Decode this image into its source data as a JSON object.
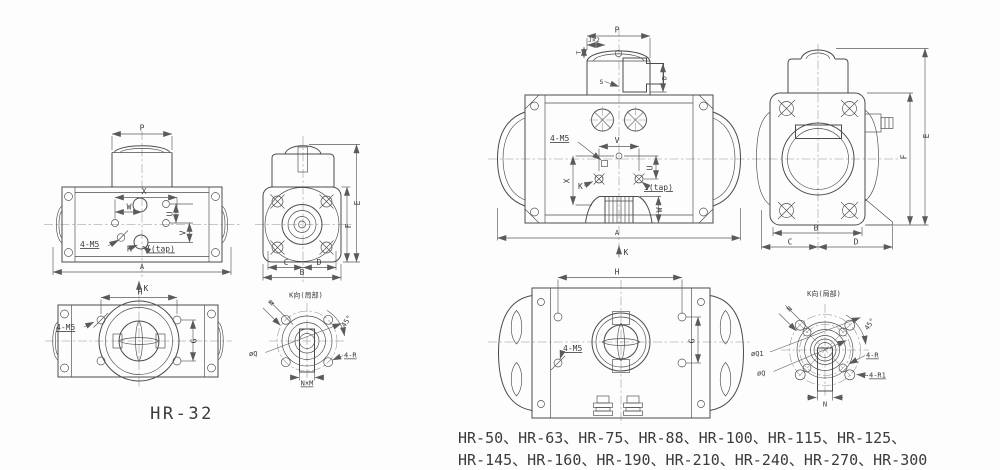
{
  "page": {
    "background": "#fdfdfd",
    "line_color": "#4b4b4b"
  },
  "left_drawing": {
    "model": "HR-32",
    "front_view": {
      "dim_p": "P",
      "dim_x": "X",
      "dim_w": "W",
      "dim_u": "U",
      "dim_v": "V",
      "label_k": "K",
      "label_i_tap": "I(tap)",
      "label_4m5": "4-M5",
      "dim_a": "A",
      "view_arrow_k": "K"
    },
    "side_view": {
      "dim_e": "E",
      "dim_f": "F",
      "dim_c": "C",
      "dim_d": "D",
      "dim_b": "B"
    },
    "bottom_view": {
      "dim_h": "H",
      "dim_g": "G",
      "label_4m5": "4-M5"
    },
    "flange_detail": {
      "title": "K向(局部)",
      "dim_n": "N",
      "dim_angle": "45°",
      "label_q": "øQ",
      "label_4r": "4-R",
      "label_nxm": "N×M"
    }
  },
  "right_drawing": {
    "models_line1": "HR-50、HR-63、HR-75、HR-88、HR-100、HR-115、HR-125、",
    "models_line2": "HR-145、HR-160、HR-190、HR-210、HR-240、HR-270、HR-300",
    "front_view": {
      "dim_p": "P",
      "dim_j": "J×2",
      "dim_t": "T",
      "label_s": "S",
      "dim_d": "D",
      "label_4m5": "4-M5",
      "dim_v": "V",
      "dim_x": "X",
      "dim_u": "U",
      "label_k": "K",
      "label_i_tap": "I(tap)",
      "dim_w": "W",
      "dim_a": "A",
      "view_arrow_k": "K"
    },
    "side_view": {
      "dim_e": "E",
      "dim_f": "F",
      "dim_b": "B",
      "dim_c": "C",
      "dim_d": "D"
    },
    "bottom_view": {
      "dim_h": "H",
      "dim_g": "G",
      "label_4m5": "4-M5"
    },
    "flange_detail": {
      "title": "K向(局部)",
      "dim_n_top": "N",
      "dim_angle": "45°",
      "label_q1": "øQ1",
      "label_q": "øQ",
      "label_4r": "4-R",
      "label_4r1": "4-R1",
      "dim_n_bottom": "N"
    }
  }
}
